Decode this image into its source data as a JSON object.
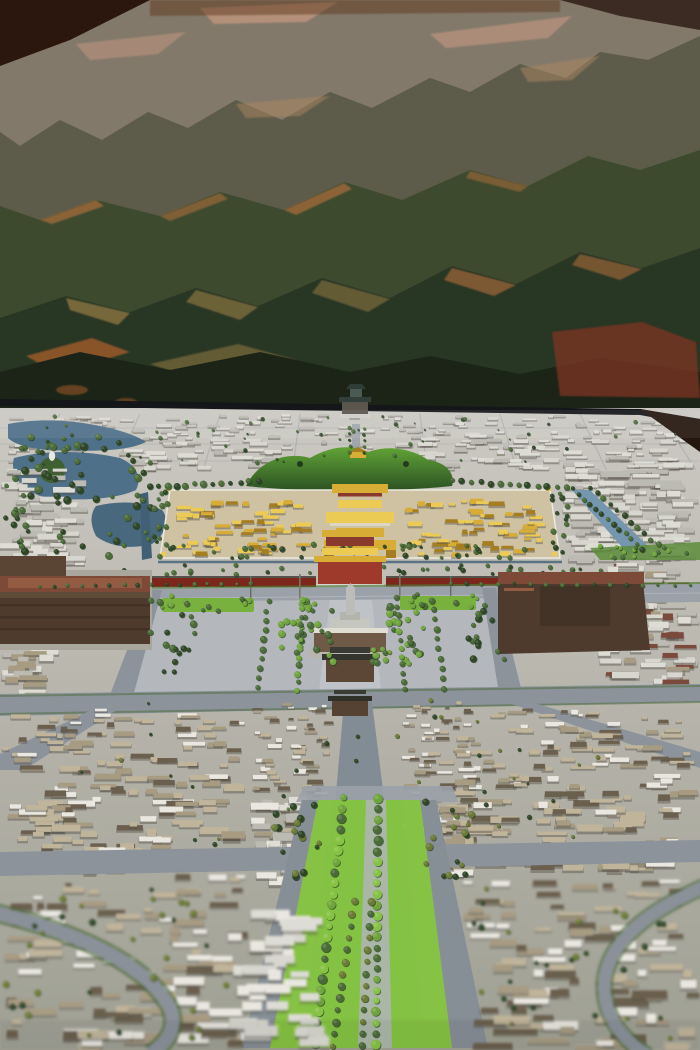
{
  "image": {
    "width": 700,
    "height": 1050,
    "type": "photograph",
    "subject": "museum scale model of Beijing old city seen along its central axis, with a painted mountain mural backdrop"
  },
  "scene": {
    "depicted": [
      "mountain mural backdrop",
      "bell and drum towers",
      "shichahai lakes",
      "beihai lake with white dagoba island",
      "jingshan hill",
      "forbidden city with golden roofs",
      "palace moat",
      "tiananmen gate with red walls",
      "changan avenue",
      "tiananmen square",
      "monument obelisk",
      "mausoleum",
      "zhengyangmen gates",
      "great hall (west brown building)",
      "museum (east brown building)",
      "hutong roofscape",
      "tree-lined central axis boulevard",
      "ring roads"
    ]
  },
  "palette": {
    "m_far": "#83796a",
    "m_far_hi": "#c79a82",
    "m_mid": "#5d5c4a",
    "m_mid_hi": "#ad8762",
    "m_mid2": "#3d4a2e",
    "m_rim": "#b5713d",
    "m_dark": "#283624",
    "m_sun": "#8a7440",
    "m_amber": "#a05c2c",
    "m_bottom": "#1b2416",
    "m_red": "#7e3424",
    "corner_dark": "#27120b",
    "top_strip": "#5a3017",
    "topright_dark": "#2b1810",
    "table_edge": "#15161a",
    "base_top": "#cbc9c2",
    "base_mid": "#b5b3a9",
    "base_bot": "#9fa094",
    "road": "#8c939b",
    "road_light": "#9aa1a8",
    "street_axis": "#828c95",
    "square": "#b4b8bd",
    "square_light": "#c2c5c9",
    "lake": "#4f7089",
    "lake_dark": "#48687e",
    "canal": "#416076",
    "moat": "#7496ae",
    "island_green": "#3f6030",
    "dagoba_white": "#e9e7e2",
    "tree_dark": "#2e4626",
    "tree_mid": "#4a6b37",
    "tree_bright": "#6fa33c",
    "tree_olive": "#6b7a35",
    "lawn": "#79b13e",
    "lawn_bright": "#86c243",
    "se_strip": "#5d8c3b",
    "jing_hi": "#61a336",
    "jing_dk": "#2c5224",
    "gold": "#d8ad36",
    "gold_hi": "#eccb55",
    "gold_dk": "#a67e22",
    "red_wall": "#7c261c",
    "red_gate": "#9e3a2b",
    "red_base": "#8a3a2c",
    "civic_wall": "#4e3b2d",
    "civic_wall2": "#6e5a46",
    "civic_roof": "#7d4a38",
    "civic_roof2": "#935c42",
    "gate_body": "#5c4736",
    "gate_roof": "#34352e",
    "gate_roof2": "#3a3b33",
    "hutong_light": "#c0b49a",
    "hutong_mid": "#a79b82",
    "hutong_dark": "#6b5f4e",
    "brick": "#7b4a3c",
    "roof_white": "#e9e7e0",
    "block_white": "#dddcd5",
    "block_light": "#d7d6cf",
    "block_gray": "#bcbbb3",
    "white_marble": "#d8d6cf",
    "monument": "#bcbdb8",
    "pale_path": "#b0b5b8",
    "grass_median": "#84c243",
    "verge_green": "#4e7a34",
    "platform": "#a9a79c"
  },
  "generator": {
    "seed": 20130907,
    "farstreets": {
      "vx": [
        60,
        140,
        220,
        300,
        420,
        500,
        580,
        660
      ],
      "vanishx": 360,
      "y0": 414,
      "y1": 470,
      "hy": [
        428,
        444,
        461
      ]
    },
    "blockfields": [
      {
        "id": "far_band",
        "x": 4,
        "y": 414,
        "w": 690,
        "h": 54,
        "rows": 8,
        "count": 300,
        "wmin": 6,
        "wmax": 24,
        "hmin": 2,
        "hmax": 5,
        "colors": [
          "block_white",
          "block_gray",
          "block_light"
        ],
        "shadow": true,
        "persp": true
      },
      {
        "id": "w_field",
        "x": 0,
        "y": 468,
        "w": 88,
        "h": 96,
        "rows": 8,
        "count": 55,
        "wmin": 8,
        "wmax": 26,
        "hmin": 3,
        "hmax": 6,
        "colors": [
          "block_white",
          "block_gray",
          "block_light"
        ],
        "shadow": true
      },
      {
        "id": "ne_field",
        "x": 562,
        "y": 468,
        "w": 136,
        "h": 92,
        "rows": 9,
        "count": 110,
        "wmin": 8,
        "wmax": 30,
        "hmin": 3,
        "hmax": 6,
        "colors": [
          "block_white",
          "block_light",
          "block_gray"
        ],
        "shadow": true
      },
      {
        "id": "e_field",
        "x": 598,
        "y": 562,
        "w": 102,
        "h": 128,
        "rows": 10,
        "count": 80,
        "wmin": 8,
        "wmax": 28,
        "hmin": 3,
        "hmax": 7,
        "colors": [
          "block_white",
          "block_gray",
          "hutong_mid",
          "brick",
          "block_light"
        ],
        "shadow": true
      },
      {
        "id": "w_mid",
        "x": 0,
        "y": 648,
        "w": 60,
        "h": 52,
        "rows": 4,
        "count": 22,
        "wmin": 10,
        "wmax": 28,
        "hmin": 4,
        "hmax": 7,
        "colors": [
          "block_gray",
          "block_white",
          "hutong_mid"
        ],
        "shadow": true
      },
      {
        "id": "gold_w",
        "x": 176,
        "y": 498,
        "w": 136,
        "h": 56,
        "rows": 6,
        "count": 55,
        "wmin": 5,
        "wmax": 16,
        "hmin": 2.5,
        "hmax": 5,
        "colors": [
          "gold",
          "gold_hi",
          "gold_dk"
        ],
        "shadow": true
      },
      {
        "id": "gold_e",
        "x": 396,
        "y": 498,
        "w": 150,
        "h": 56,
        "rows": 6,
        "count": 55,
        "wmin": 5,
        "wmax": 16,
        "hmin": 2.5,
        "hmax": 5,
        "colors": [
          "gold",
          "gold_hi",
          "gold_dk"
        ],
        "shadow": true
      },
      {
        "id": "hutong_left",
        "x": 2,
        "y": 708,
        "w": 246,
        "h": 160,
        "rows": 10,
        "count": 170,
        "wmin": 8,
        "wmax": 34,
        "hmin": 4,
        "hmax": 8,
        "colors": [
          "hutong_light",
          "hutong_mid",
          "hutong_dark",
          "roof_white",
          "hutong_light"
        ],
        "shadow": true,
        "persp": true
      },
      {
        "id": "hutong_right",
        "x": 452,
        "y": 708,
        "w": 246,
        "h": 160,
        "rows": 10,
        "count": 170,
        "wmin": 8,
        "wmax": 34,
        "hmin": 4,
        "hmax": 8,
        "colors": [
          "hutong_light",
          "hutong_mid",
          "hutong_dark",
          "roof_white",
          "hutong_light"
        ],
        "shadow": true,
        "persp": true
      },
      {
        "id": "hutong_center_l",
        "x": 252,
        "y": 700,
        "w": 82,
        "h": 152,
        "rows": 11,
        "count": 80,
        "wmin": 6,
        "wmax": 20,
        "hmin": 3,
        "hmax": 6,
        "colors": [
          "roof_white",
          "hutong_light",
          "hutong_mid",
          "hutong_dark"
        ],
        "shadow": true,
        "persp": true
      },
      {
        "id": "hutong_center_r",
        "x": 398,
        "y": 700,
        "w": 84,
        "h": 152,
        "rows": 11,
        "count": 80,
        "wmin": 6,
        "wmax": 20,
        "hmin": 3,
        "hmax": 6,
        "colors": [
          "roof_white",
          "hutong_light",
          "hutong_mid",
          "hutong_dark"
        ],
        "shadow": true,
        "persp": true
      },
      {
        "id": "mid_white",
        "x": 250,
        "y": 796,
        "w": 78,
        "h": 84,
        "rows": 5,
        "count": 22,
        "wmin": 10,
        "wmax": 30,
        "hmin": 5,
        "hmax": 9,
        "colors": [
          "roof_white",
          "block_white",
          "block_gray"
        ],
        "shadow": true
      },
      {
        "id": "e_pocket",
        "x": 424,
        "y": 800,
        "w": 52,
        "h": 80,
        "rows": 5,
        "count": 16,
        "wmin": 8,
        "wmax": 22,
        "hmin": 4,
        "hmax": 8,
        "colors": [
          "hutong_light",
          "hutong_mid",
          "roof_white"
        ],
        "shadow": true
      },
      {
        "id": "fg_left",
        "x": 0,
        "y": 874,
        "w": 252,
        "h": 174,
        "rows": 8,
        "count": 100,
        "wmin": 10,
        "wmax": 44,
        "hmin": 5,
        "hmax": 10,
        "colors": [
          "hutong_light",
          "hutong_mid",
          "hutong_dark",
          "roof_white"
        ],
        "shadow": true,
        "persp": true
      },
      {
        "id": "fg_right",
        "x": 458,
        "y": 874,
        "w": 242,
        "h": 174,
        "rows": 8,
        "count": 95,
        "wmin": 10,
        "wmax": 44,
        "hmin": 5,
        "hmax": 10,
        "colors": [
          "hutong_light",
          "hutong_mid",
          "hutong_dark",
          "roof_white"
        ],
        "shadow": true,
        "persp": true
      },
      {
        "id": "fg_white",
        "x": 228,
        "y": 908,
        "w": 104,
        "h": 138,
        "rows": 6,
        "count": 34,
        "wmin": 12,
        "wmax": 36,
        "hmin": 6,
        "hmax": 12,
        "colors": [
          "roof_white",
          "block_white",
          "block_light"
        ],
        "shadow": true
      }
    ],
    "treefields": [
      {
        "g": "trees-north",
        "x": 0,
        "y": 436,
        "w": 155,
        "h": 120,
        "n": 70,
        "rmin": 2,
        "rmax": 4,
        "colors": [
          "tree_dark",
          "tree_mid"
        ]
      },
      {
        "g": "trees-north",
        "x": 8,
        "y": 416,
        "w": 684,
        "h": 48,
        "n": 55,
        "rmin": 0.8,
        "rmax": 2,
        "colors": [
          "tree_dark",
          "tree_mid"
        ]
      },
      {
        "g": "trees-north",
        "x": 152,
        "y": 490,
        "w": 16,
        "h": 70,
        "n": 14,
        "rmin": 1.8,
        "rmax": 3,
        "colors": [
          "tree_dark",
          "tree_mid"
        ]
      },
      {
        "g": "trees-north",
        "x": 552,
        "y": 490,
        "w": 18,
        "h": 70,
        "n": 14,
        "rmin": 1.8,
        "rmax": 3,
        "colors": [
          "tree_dark",
          "tree_mid"
        ]
      },
      {
        "g": "trees-north",
        "x": 170,
        "y": 544,
        "w": 380,
        "h": 14,
        "n": 46,
        "rmin": 1.5,
        "rmax": 3,
        "colors": [
          "tree_dark",
          "tree_mid"
        ]
      },
      {
        "g": "trees-north",
        "x": 120,
        "y": 565,
        "w": 500,
        "h": 10,
        "n": 40,
        "rmin": 1.5,
        "rmax": 2.6,
        "colors": [
          "tree_mid",
          "tree_dark"
        ]
      },
      {
        "g": "trees-north",
        "x": 592,
        "y": 544,
        "w": 106,
        "h": 14,
        "n": 16,
        "rmin": 1.5,
        "rmax": 2.6,
        "colors": [
          "tree_mid",
          "tree_bright"
        ]
      },
      {
        "g": "trees-square",
        "x": 280,
        "y": 600,
        "w": 54,
        "h": 64,
        "n": 30,
        "rmin": 2.2,
        "rmax": 3.6,
        "colors": [
          "tree_mid",
          "tree_bright"
        ]
      },
      {
        "g": "trees-square",
        "x": 372,
        "y": 600,
        "w": 54,
        "h": 64,
        "n": 30,
        "rmin": 2.2,
        "rmax": 3.6,
        "colors": [
          "tree_mid",
          "tree_bright"
        ]
      },
      {
        "g": "trees-square",
        "x": 160,
        "y": 595,
        "w": 95,
        "h": 16,
        "n": 12,
        "rmin": 1.8,
        "rmax": 3,
        "colors": [
          "tree_mid",
          "tree_bright"
        ]
      },
      {
        "g": "trees-square",
        "x": 402,
        "y": 593,
        "w": 76,
        "h": 16,
        "n": 10,
        "rmin": 1.8,
        "rmax": 3,
        "colors": [
          "tree_mid",
          "tree_bright"
        ]
      },
      {
        "g": "trees-square",
        "x": 148,
        "y": 598,
        "w": 56,
        "h": 75,
        "n": 18,
        "rmin": 2.2,
        "rmax": 3.8,
        "colors": [
          "tree_mid",
          "tree_dark"
        ]
      },
      {
        "g": "trees-square",
        "x": 468,
        "y": 594,
        "w": 42,
        "h": 78,
        "n": 14,
        "rmin": 2.2,
        "rmax": 3.8,
        "colors": [
          "tree_mid",
          "tree_dark"
        ]
      },
      {
        "g": "trees-mid",
        "x": 80,
        "y": 700,
        "w": 550,
        "h": 165,
        "n": 45,
        "rmin": 1.2,
        "rmax": 2.4,
        "colors": [
          "tree_dark",
          "tree_olive"
        ]
      },
      {
        "g": "trees-boulevard",
        "x": 262,
        "y": 800,
        "w": 58,
        "h": 78,
        "n": 16,
        "rmin": 2.2,
        "rmax": 3.8,
        "colors": [
          "tree_olive",
          "tree_dark"
        ]
      },
      {
        "g": "trees-boulevard",
        "x": 424,
        "y": 800,
        "w": 56,
        "h": 78,
        "n": 16,
        "rmin": 2.2,
        "rmax": 3.8,
        "colors": [
          "tree_olive",
          "tree_dark"
        ]
      },
      {
        "g": "trees-fg",
        "x": 0,
        "y": 880,
        "w": 240,
        "h": 165,
        "n": 30,
        "rmin": 2,
        "rmax": 3.6,
        "colors": [
          "tree_olive",
          "tree_dark"
        ]
      },
      {
        "g": "trees-fg",
        "x": 470,
        "y": 880,
        "w": 225,
        "h": 165,
        "n": 28,
        "rmin": 2,
        "rmax": 3.6,
        "colors": [
          "tree_olive",
          "tree_dark"
        ]
      }
    ],
    "treelines": [
      {
        "g": "trees-north",
        "x1": 573,
        "y1": 489,
        "x2": 643,
        "y2": 549,
        "n": 13,
        "rmin": 1.8,
        "rmax": 3,
        "colors": [
          "tree_dark",
          "tree_mid"
        ],
        "j": 2
      },
      {
        "g": "trees-north",
        "x1": 590,
        "y1": 487,
        "x2": 658,
        "y2": 545,
        "n": 11,
        "rmin": 1.8,
        "rmax": 3,
        "colors": [
          "tree_dark",
          "tree_mid"
        ],
        "j": 2
      },
      {
        "g": "trees-north",
        "x1": 350,
        "y1": 428,
        "x2": 350,
        "y2": 452,
        "n": 5,
        "rmin": 1.2,
        "rmax": 2,
        "colors": [
          "tree_dark",
          "tree_mid"
        ],
        "j": 1.5
      },
      {
        "g": "trees-north",
        "x1": 364,
        "y1": 428,
        "x2": 364,
        "y2": 452,
        "n": 5,
        "rmin": 1.2,
        "rmax": 2,
        "colors": [
          "tree_dark",
          "tree_mid"
        ],
        "j": 1.5
      },
      {
        "g": "trees-north",
        "x1": 150,
        "y1": 487,
        "x2": 258,
        "y2": 481,
        "n": 13,
        "rmin": 2,
        "rmax": 3.6,
        "colors": [
          "tree_mid",
          "tree_dark"
        ],
        "j": 2.5
      },
      {
        "g": "trees-north",
        "x1": 452,
        "y1": 481,
        "x2": 566,
        "y2": 488,
        "n": 13,
        "rmin": 2,
        "rmax": 3.6,
        "colors": [
          "tree_mid",
          "tree_dark"
        ],
        "j": 2.5
      },
      {
        "g": "trees-square",
        "x1": 303,
        "y1": 600,
        "x2": 297,
        "y2": 690,
        "n": 12,
        "rmin": 2.2,
        "rmax": 3.4,
        "colors": [
          "tree_mid",
          "tree_bright"
        ],
        "j": 2
      },
      {
        "g": "trees-square",
        "x1": 397,
        "y1": 598,
        "x2": 404,
        "y2": 690,
        "n": 12,
        "rmin": 2.2,
        "rmax": 3.4,
        "colors": [
          "tree_mid",
          "tree_bright"
        ],
        "j": 2
      },
      {
        "g": "trees-square",
        "x1": 268,
        "y1": 602,
        "x2": 258,
        "y2": 688,
        "n": 10,
        "rmin": 2.4,
        "rmax": 3.8,
        "colors": [
          "tree_mid"
        ],
        "j": 2.5
      },
      {
        "g": "trees-square",
        "x1": 432,
        "y1": 600,
        "x2": 444,
        "y2": 688,
        "n": 10,
        "rmin": 2.4,
        "rmax": 3.8,
        "colors": [
          "tree_mid"
        ],
        "j": 2.5
      },
      {
        "g": "trees-square",
        "x1": 40,
        "y1": 586,
        "x2": 250,
        "y2": 583,
        "n": 16,
        "rmin": 1.4,
        "rmax": 2.4,
        "colors": [
          "tree_mid",
          "tree_dark"
        ],
        "j": 2
      },
      {
        "g": "trees-square",
        "x1": 450,
        "y1": 583,
        "x2": 690,
        "y2": 586,
        "n": 16,
        "rmin": 1.4,
        "rmax": 2.4,
        "colors": [
          "tree_mid",
          "tree_dark"
        ],
        "j": 2
      },
      {
        "g": "trees-boulevard",
        "x1": 344,
        "y1": 798,
        "x2": 315,
        "y2": 1044,
        "n": 24,
        "rmin": 3.2,
        "rmax": 5,
        "colors": [
          "tree_bright",
          "tree_mid",
          "lawn_bright"
        ],
        "j": 1.6
      },
      {
        "g": "trees-boulevard",
        "x1": 378,
        "y1": 798,
        "x2": 376,
        "y2": 1044,
        "n": 24,
        "rmin": 3.2,
        "rmax": 5,
        "colors": [
          "tree_bright",
          "tree_mid",
          "lawn_bright"
        ],
        "j": 1.6
      },
      {
        "g": "trees-boulevard",
        "x1": 354,
        "y1": 902,
        "x2": 332,
        "y2": 1046,
        "n": 13,
        "rmin": 2.8,
        "rmax": 4.2,
        "colors": [
          "tree_olive",
          "tree_mid"
        ],
        "j": 1.6
      },
      {
        "g": "trees-boulevard",
        "x1": 371,
        "y1": 902,
        "x2": 362,
        "y2": 1046,
        "n": 13,
        "rmin": 2.8,
        "rmax": 4.2,
        "colors": [
          "tree_olive",
          "tree_mid"
        ],
        "j": 1.6
      }
    ]
  }
}
